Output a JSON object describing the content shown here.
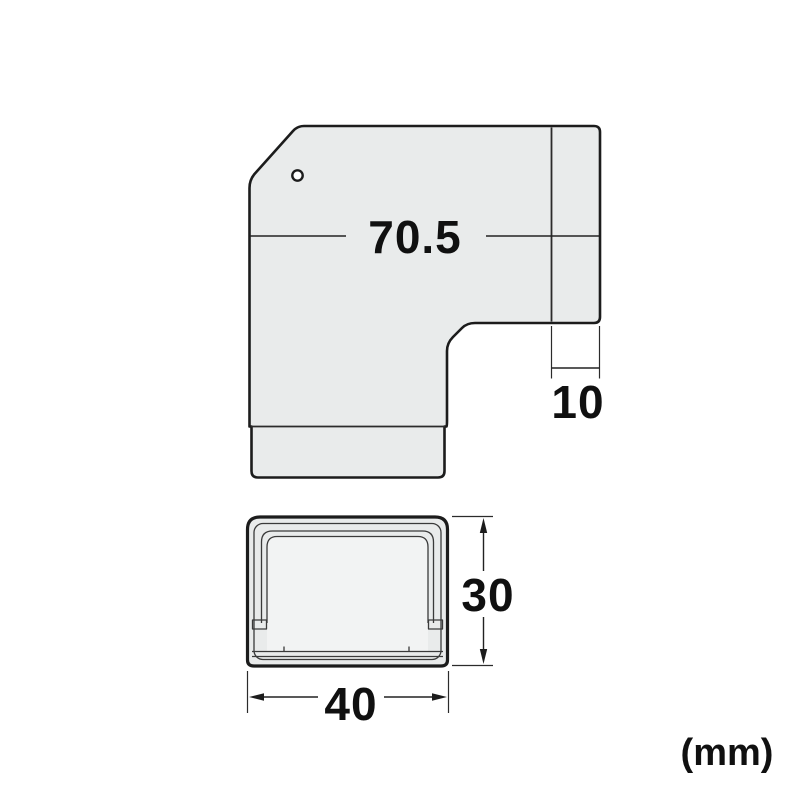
{
  "colors": {
    "background": "#ffffff",
    "shape_fill": "#e9ebeb",
    "inner_panel_fill": "#f2f3f3",
    "hole_fill": "#ffffff",
    "outline": "#1c1c1c",
    "dim_text": "#101010"
  },
  "top_view": {
    "dim_width": {
      "label": "70.5",
      "value": 70.5
    },
    "dim_depth": {
      "label": "10",
      "value": 10
    }
  },
  "section_view": {
    "dim_height": {
      "label": "30",
      "value": 30
    },
    "dim_width": {
      "label": "40",
      "value": 40
    }
  },
  "unit_note": {
    "label": "(mm)"
  }
}
